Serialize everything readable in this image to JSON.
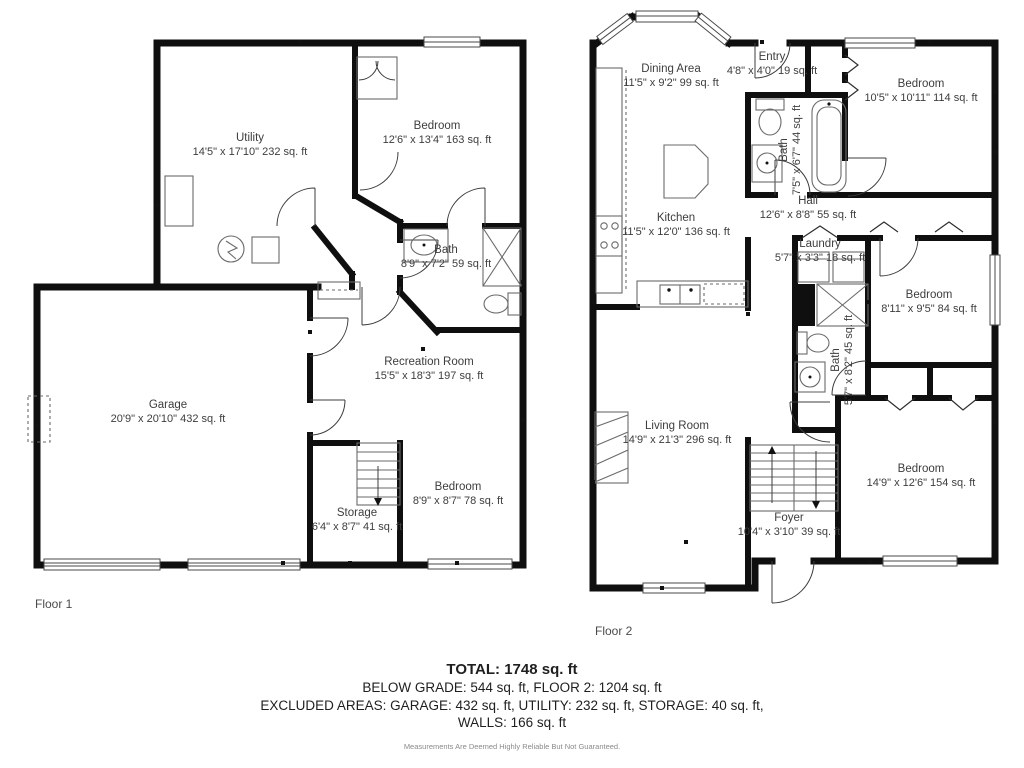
{
  "floors": [
    {
      "name": "Floor 1",
      "rooms": [
        {
          "label": "Utility",
          "dims": "14'5\" x 17'10\" 232 sq. ft"
        },
        {
          "label": "Bedroom",
          "dims": "12'6\" x 13'4\" 163 sq. ft"
        },
        {
          "label": "Bath",
          "dims": "8'9\" x 7'2\" 59 sq. ft"
        },
        {
          "label": "Garage",
          "dims": "20'9\" x 20'10\" 432 sq. ft"
        },
        {
          "label": "Recreation Room",
          "dims": "15'5\" x 18'3\" 197 sq. ft"
        },
        {
          "label": "Bedroom",
          "dims": "8'9\" x 8'7\" 78 sq. ft"
        },
        {
          "label": "Storage",
          "dims": "6'4\" x 8'7\" 41 sq. ft"
        }
      ]
    },
    {
      "name": "Floor 2",
      "rooms": [
        {
          "label": "Dining Area",
          "dims": "11'5\" x 9'2\" 99 sq. ft"
        },
        {
          "label": "Entry",
          "dims": "4'8\" x 4'0\" 19 sq. ft"
        },
        {
          "label": "Bedroom",
          "dims": "10'5\" x 10'11\" 114 sq. ft"
        },
        {
          "label": "Bath",
          "dims": "7'5\" x 6'7\" 44 sq. ft"
        },
        {
          "label": "Hall",
          "dims": "12'6\" x 8'8\" 55 sq. ft"
        },
        {
          "label": "Kitchen",
          "dims": "11'5\" x 12'0\" 136 sq. ft"
        },
        {
          "label": "Laundry",
          "dims": "5'7\" x 3'3\" 18 sq. ft"
        },
        {
          "label": "Bedroom",
          "dims": "8'11\" x 9'5\" 84 sq. ft"
        },
        {
          "label": "Bath",
          "dims": "5'7\" x 8'2\" 45 sq. ft"
        },
        {
          "label": "Living Room",
          "dims": "14'9\" x 21'3\" 296 sq. ft"
        },
        {
          "label": "Bedroom",
          "dims": "14'9\" x 12'6\" 154 sq. ft"
        },
        {
          "label": "Foyer",
          "dims": "10'4\" x 3'10\" 39 sq. ft"
        }
      ]
    }
  ],
  "summary": {
    "total": "TOTAL: 1748 sq. ft",
    "line2": "BELOW GRADE: 544 sq. ft, FLOOR 2: 1204 sq. ft",
    "line3": "EXCLUDED AREAS: GARAGE: 432 sq. ft, UTILITY: 232 sq. ft, STORAGE: 40 sq. ft,",
    "line4": "WALLS: 166 sq. ft",
    "disclaimer": "Measurements Are Deemed Highly Reliable But Not Guaranteed."
  },
  "colors": {
    "wall": "#0f0f0f",
    "text": "#3d3d3d"
  }
}
